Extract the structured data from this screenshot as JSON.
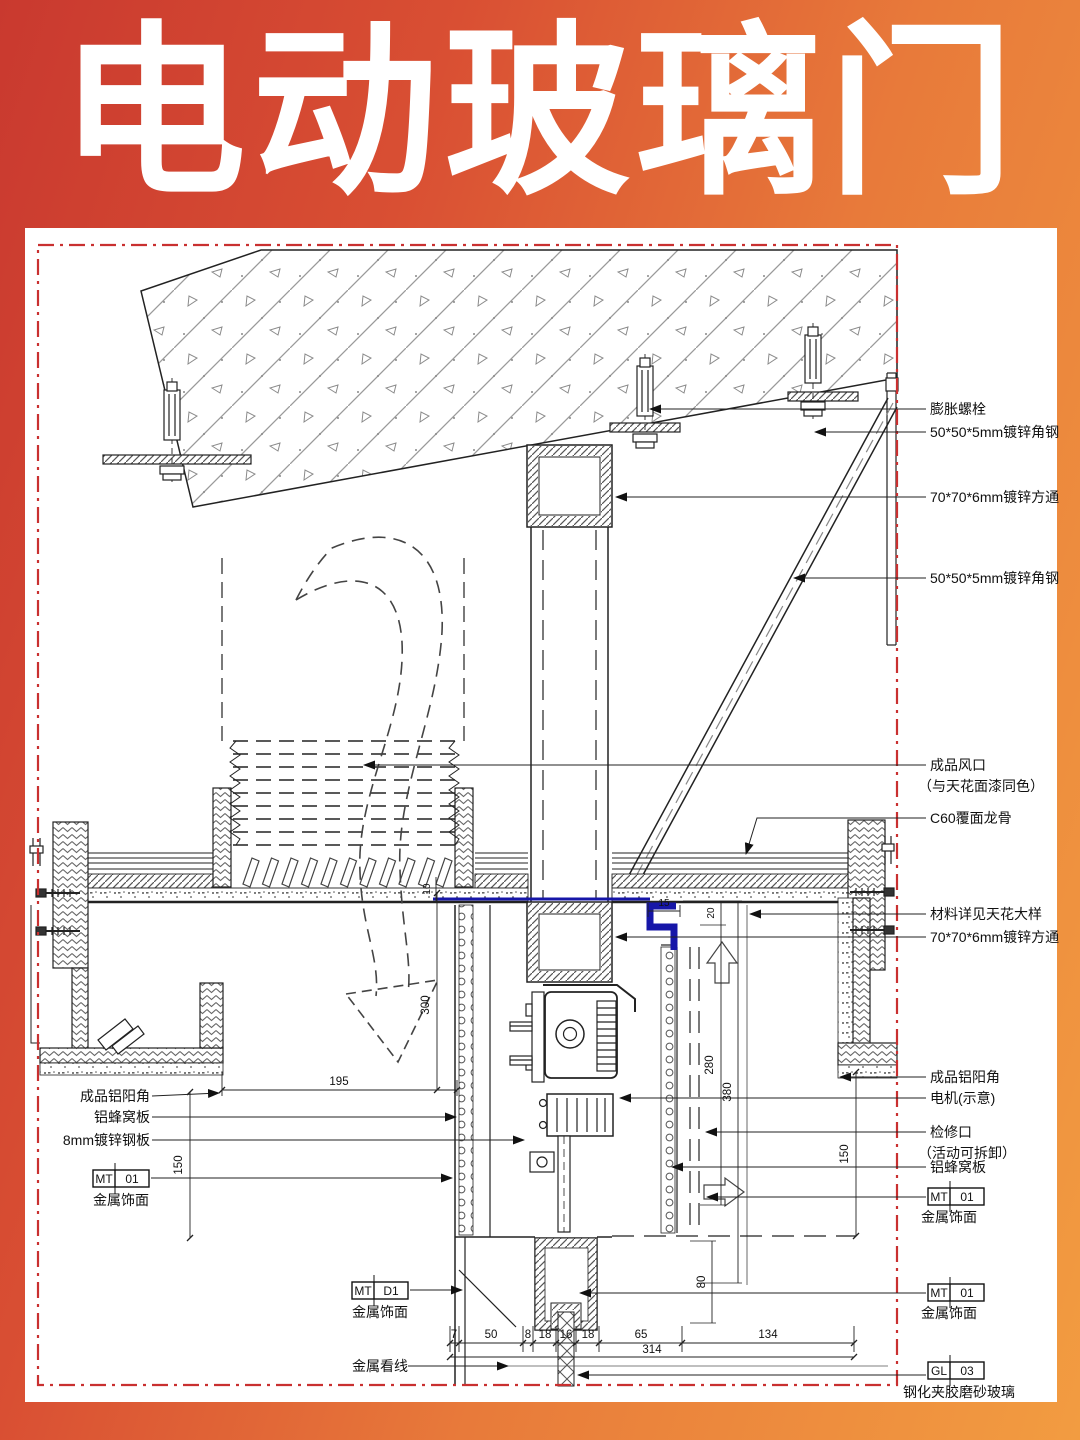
{
  "title": "电动玻璃门",
  "colors": {
    "gradient_left": "#c9392f",
    "gradient_right": "#f2a043",
    "border_red": "#c93030",
    "highlight_blue": "#1616a8"
  },
  "annotations": {
    "right": [
      {
        "text": "膨胀螺栓",
        "sub": ""
      },
      {
        "text": "50*50*5mm镀锌角钢",
        "sub": ""
      },
      {
        "text": "70*70*6mm镀锌方通",
        "sub": ""
      },
      {
        "text": "50*50*5mm镀锌角钢",
        "sub": ""
      },
      {
        "text": "成品风口",
        "sub": "（与天花面漆同色）"
      },
      {
        "text": "C60覆面龙骨",
        "sub": ""
      },
      {
        "text": "材料详见天花大样",
        "sub": ""
      },
      {
        "text": "70*70*6mm镀锌方通",
        "sub": ""
      },
      {
        "text": "成品铝阳角",
        "sub": ""
      },
      {
        "text": "电机(示意)",
        "sub": ""
      },
      {
        "text": "检修口",
        "sub": "（活动可拆卸）"
      },
      {
        "text": "铝蜂窝板",
        "sub": ""
      }
    ],
    "left": [
      {
        "text": "成品铝阳角"
      },
      {
        "text": "铝蜂窝板"
      },
      {
        "text": "8mm镀锌钢板"
      }
    ],
    "sightline": "金属看线"
  },
  "tags": {
    "mt_right_1": {
      "code": "MT",
      "num": "01",
      "name": "金属饰面"
    },
    "mt_right_2": {
      "code": "MT",
      "num": "01",
      "name": "金属饰面"
    },
    "mt_left": {
      "code": "MT",
      "num": "01",
      "name": "金属饰面"
    },
    "mt_bottom": {
      "code": "MT",
      "num": "D1",
      "name": "金属饰面"
    },
    "gl": {
      "code": "GL",
      "num": "03",
      "name": "钢化夹胶磨砂玻璃"
    }
  },
  "dims": {
    "chain": [
      "7",
      "50",
      "8",
      "18",
      "16",
      "18",
      "65",
      "134"
    ],
    "total": "314",
    "d10": "10",
    "d15": "15",
    "d20": "20",
    "d80": "80",
    "d150_left": "150",
    "d150_right": "150",
    "d195": "195",
    "d280": "280",
    "d300": "300",
    "d380": "380"
  }
}
